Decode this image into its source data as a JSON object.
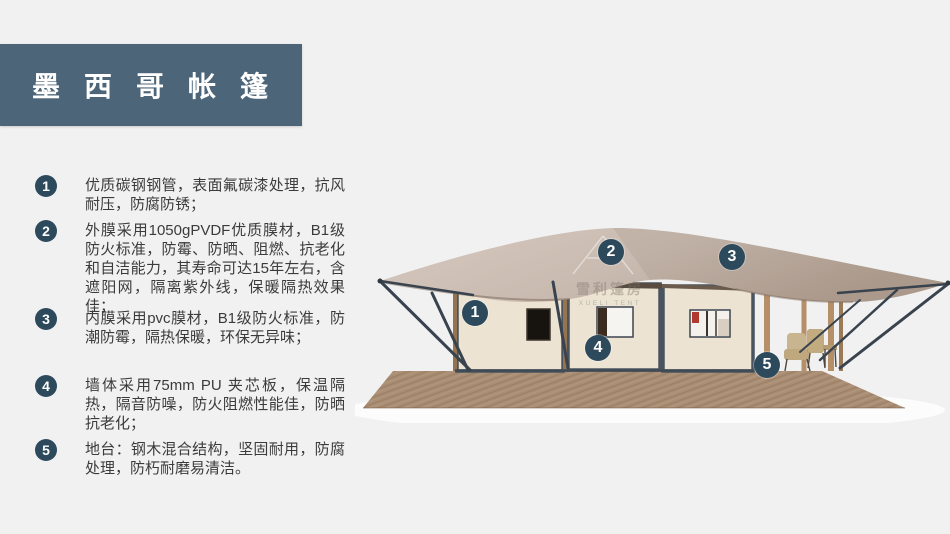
{
  "title": {
    "text": "墨西哥帐篷"
  },
  "features": [
    {
      "num": "1",
      "text": "优质碳钢钢管，表面氟碳漆处理，抗风耐压，防腐防锈；"
    },
    {
      "num": "2",
      "text": "外膜采用1050gPVDF优质膜材，B1级防火标准，防霉、防晒、阻燃、抗老化和自洁能力，其寿命可达15年左右，含遮阳网，隔离紫外线，保暖隔热效果佳；"
    },
    {
      "num": "3",
      "text": "内膜采用pvc膜材，B1级防火标准，防潮防霉，隔热保暖，环保无异味；"
    },
    {
      "num": "4",
      "text": "墙体采用75mm PU 夹芯板，保温隔热，隔音防噪，防火阻燃性能佳，防晒抗老化；"
    },
    {
      "num": "5",
      "text": "地台：钢木混合结构，坚固耐用，防腐处理，防朽耐磨易清洁。"
    }
  ],
  "diagram": {
    "callouts": [
      {
        "num": "1"
      },
      {
        "num": "2"
      },
      {
        "num": "3"
      },
      {
        "num": "4"
      },
      {
        "num": "5"
      }
    ],
    "watermark": {
      "cn": "雪利篷房",
      "en": "XUELI TENT"
    }
  },
  "colors": {
    "page_bg": "#f1f1f2",
    "title_bg": "#4c6578",
    "accent_circle": "#2d4a5c",
    "body_text": "#3b3b3b",
    "roof": "#cdbfb3",
    "wall": "#ece3d2",
    "frame": "#49545f",
    "deck_wood": "#aa8e74",
    "porch_wood": "#b48f68"
  }
}
